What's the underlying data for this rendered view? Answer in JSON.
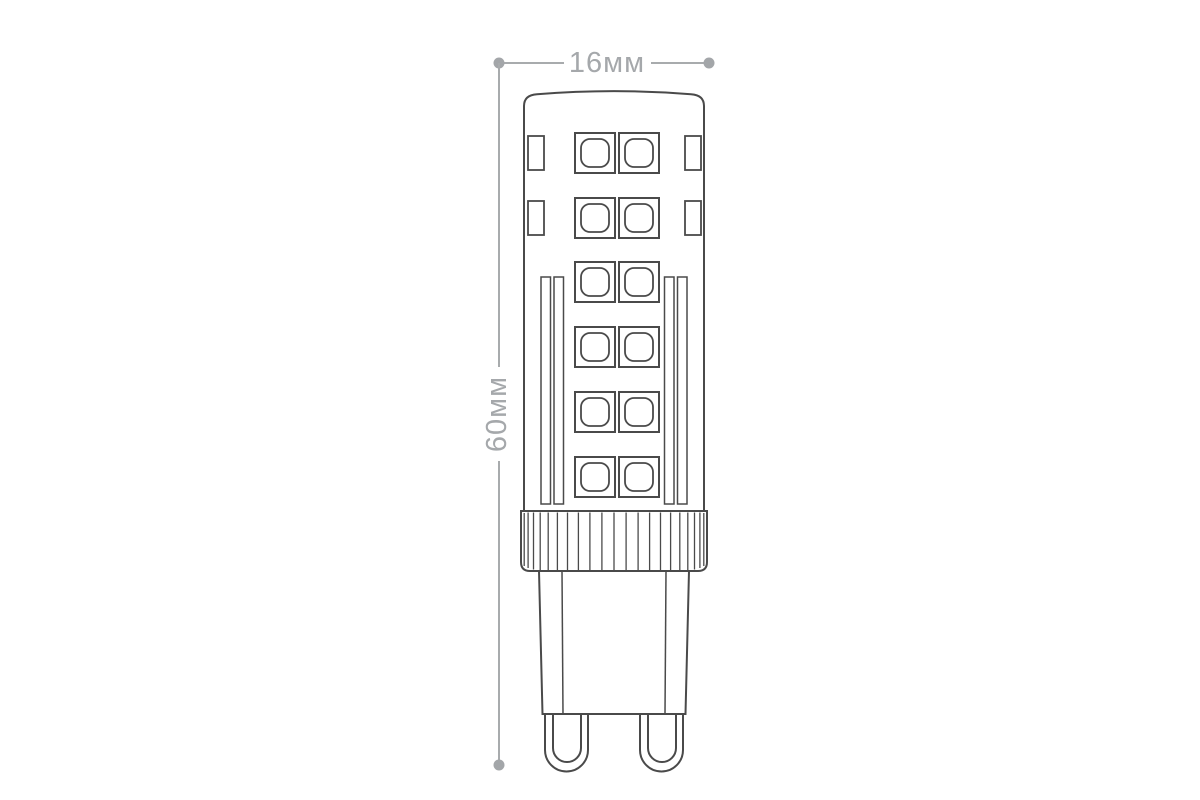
{
  "diagram": {
    "subject": "g9-led-capsule-bulb-dimensional-drawing",
    "width_label": "16мм",
    "height_label": "60мм",
    "width_mm": 16,
    "height_mm": 60,
    "units": "мм",
    "led_chip_rows": 6,
    "led_chips_per_row": 2,
    "colors": {
      "background": "#ffffff",
      "bulb_outline": "#4a4a4a",
      "dimension_gray": "#a5a8ab"
    }
  }
}
